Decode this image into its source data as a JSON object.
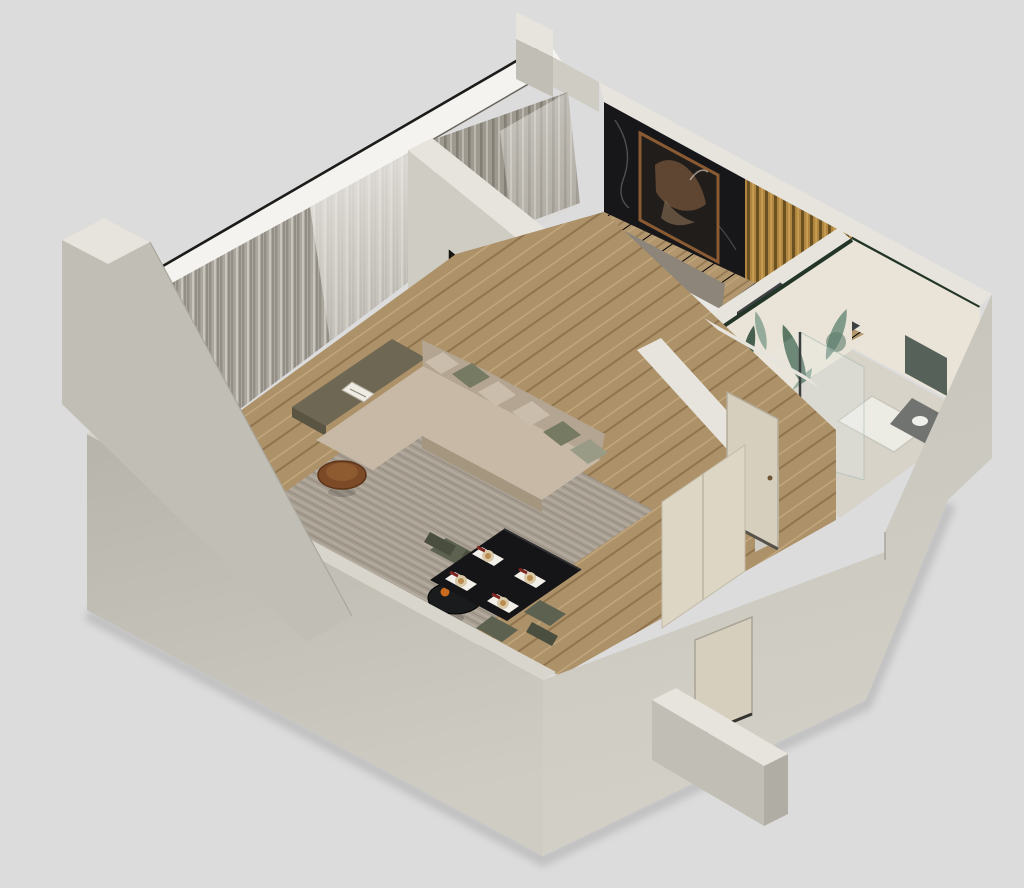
{
  "image": {
    "type": "isometric-3d-floor-plan-render",
    "description": "3D cutaway axonometric render of a one-bedroom apartment: living room with L-shaped sofa and dining set, bedroom with black marble and wood-slat accent walls, bathroom with tropical leaf wallpaper and glass shower, hallway with doors, surrounded by thick cut walls on a light gray background",
    "background": "#dcdcdd"
  },
  "colors": {
    "bg": "#dcdcdd",
    "wallFace": "#c1bfb5",
    "wallFaceLight": "#cfcdc3",
    "wallTop": "#d7d5cc",
    "wallTopLight": "#e6e4dc",
    "floorWood": "#b2966e",
    "floorWoodLine": "#977c56",
    "rugLiving": "#a89f93",
    "rugBedroom": "#d3ccc0",
    "sofa": "#c7b9a6",
    "sofaShade": "#b3a591",
    "pillowOlive": "#767a62",
    "pillowBeige": "#cabdab",
    "pillowSage": "#999b86",
    "curtainDrape": "#aba79e",
    "curtainSheer": "#e4e1dc",
    "marbleBlack": "#17171a",
    "slatWood": "#b08540",
    "artFrame": "#8a5a33",
    "blanket": "#9b9b99",
    "bedWhite": "#e9e7e3",
    "headboard": "#8d8579",
    "nightstandWood": "#a9814e",
    "wardrobe": "#3e4144",
    "wardrobeFace": "#2d2f31",
    "benchGray": "#8f8f8d",
    "leafDark": "#41604f",
    "leafLight": "#7e9c8c",
    "bathWall": "#e9e4d7",
    "tileStrip": "#223527",
    "tableBlack": "#151517",
    "chairOlive": "#5d6150",
    "chairOliveDark": "#4a4e3e",
    "consoleWood": "#c49a55",
    "copper": "#7c4a27",
    "doorBeige": "#d6cfbe",
    "glassTint": "#e8f2f2",
    "accentOrange": "#c96a1e",
    "phoneBlue": "#4aa8e8",
    "plate": "#d9c9a8",
    "napkinRed": "#7e2620"
  },
  "inventory": {
    "living_room": [
      "l-shaped-beige-sofa",
      "olive-and-beige-pillows",
      "attached-olive-side-table-with-book",
      "copper-round-side-table",
      "black-round-coffee-table-with-candle",
      "gray-area-rug",
      "abstract-art-on-partition-wall",
      "floor-to-ceiling-curtains",
      "wooden-console-along-wall"
    ],
    "dining_area": [
      "black-square-dining-table",
      "four-place-settings",
      "four-olive-chairs",
      "oak-plank-flooring"
    ],
    "bedroom": [
      "double-bed-gray-blanket",
      "white-and-checkered-pillows",
      "black-marble-accent-wall",
      "horse-artwork-copper-frame",
      "golden-wood-slat-wall",
      "white-nightstand-with-lamp",
      "wood-nightstand-with-phone",
      "dark-wardrobe",
      "upholstered-bench",
      "light-rug",
      "curtains"
    ],
    "bathroom": [
      "tropical-leaf-wallpaper",
      "glass-shower-screen",
      "white-shower-tray",
      "dark-vanity",
      "tile-border"
    ],
    "hallway": [
      "bathroom-door",
      "entry-door",
      "closet-panels"
    ]
  }
}
